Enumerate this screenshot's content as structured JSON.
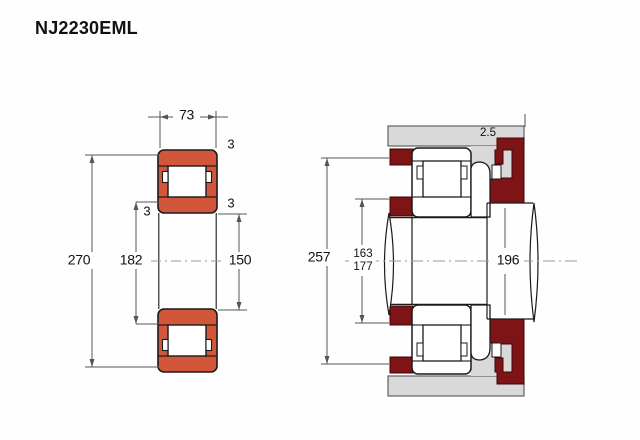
{
  "title": "NJ2230EML",
  "left_view": {
    "name": "bearing cross-section",
    "dim_width": "73",
    "dim_outer_diameter": "270",
    "dim_rib_diameter": "182",
    "dim_bore_diameter": "150",
    "chamfer_outer": "3",
    "chamfer_left": "3",
    "chamfer_right": "3"
  },
  "right_view": {
    "name": "mounting arrangement",
    "dim_housing_abutment_diameter": "257",
    "dim_shaft_abutment_min": "163",
    "dim_shaft_abutment_max": "177",
    "dim_collar_diameter": "196",
    "dim_fillet_radius": "2.5"
  },
  "colors": {
    "bearing_ring_fill": "#d2573a",
    "abutment_fill": "#7e1416",
    "housing_fill": "#d9d9d9",
    "outline": "#1a1a1a",
    "dimension_line": "#555555"
  }
}
